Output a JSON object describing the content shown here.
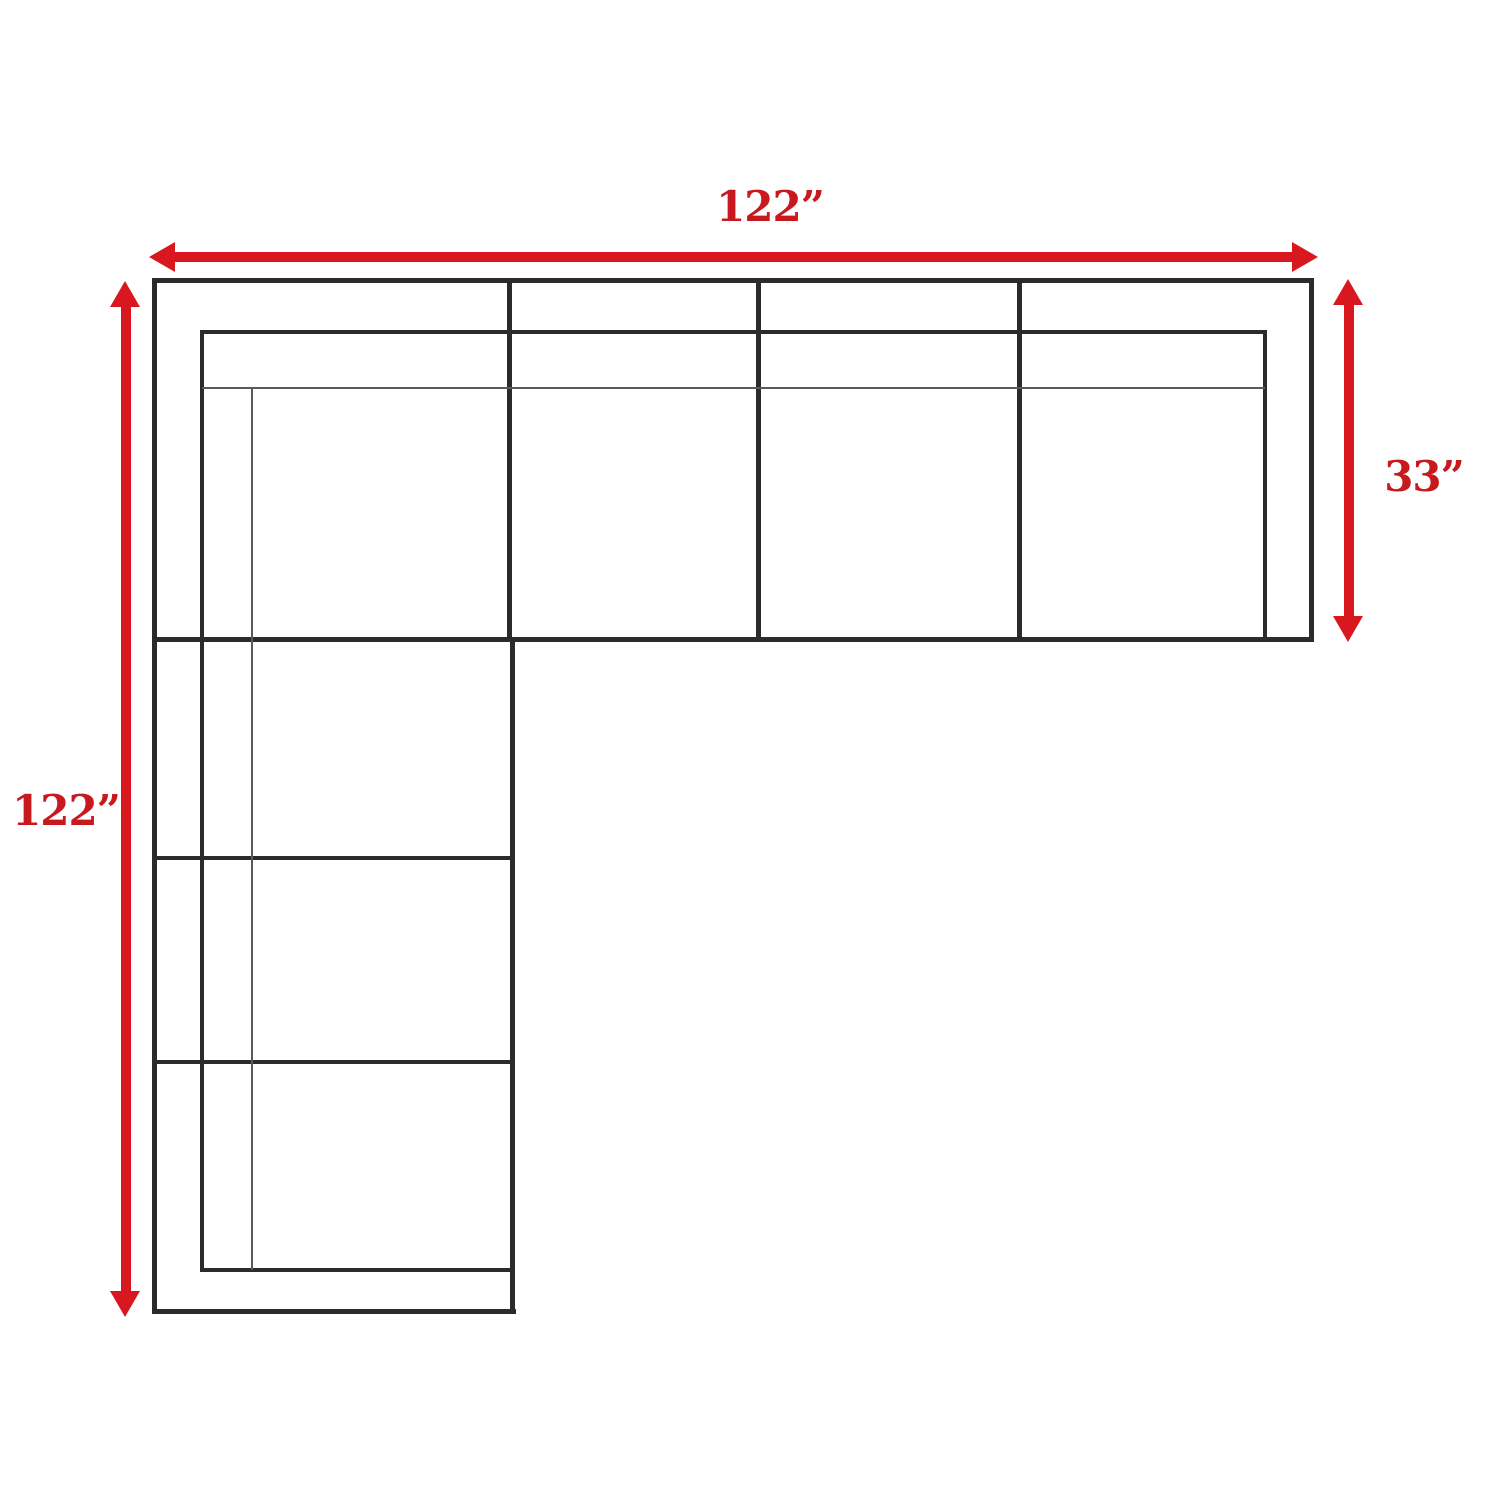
{
  "diagram": {
    "type": "sectional-sofa-top-view-dimension-diagram",
    "dimensions": {
      "top": {
        "label": "122”",
        "value_inches": 122
      },
      "left": {
        "label": "122”",
        "value_inches": 122
      },
      "right": {
        "label": "33”",
        "value_inches": 33
      }
    },
    "colors": {
      "arrow_red": "#d8171e",
      "label_red": "#c8191f",
      "outline_black": "#2b2b2b",
      "thin_line_gray": "#5a5a5a",
      "background": "#ffffff"
    }
  }
}
